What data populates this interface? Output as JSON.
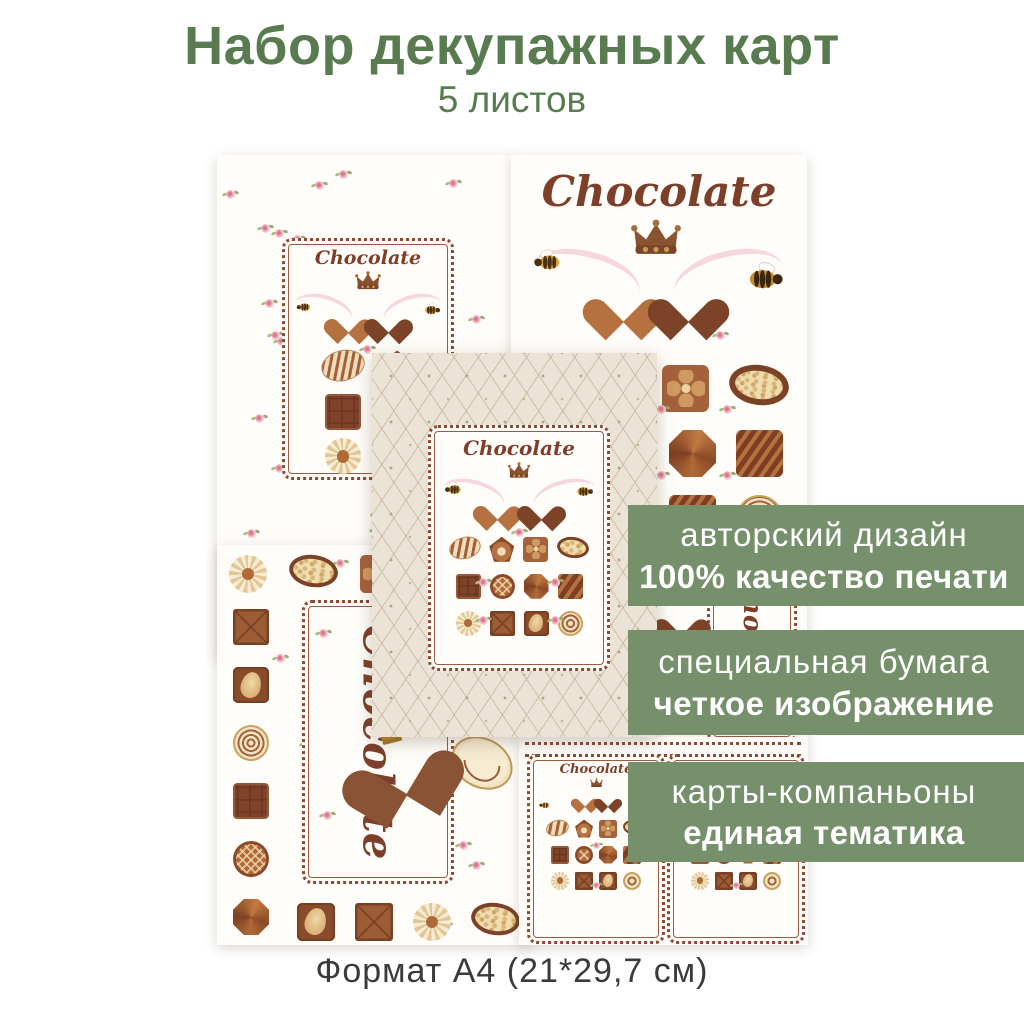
{
  "header": {
    "title": "Набор декупажных карт",
    "subtitle": "5 листов",
    "color": "#587b50"
  },
  "footer": {
    "caption": "Формат А4 (21*29,7 см)",
    "color": "#3b3b3b"
  },
  "banners": {
    "color": "#75906b",
    "items": [
      {
        "line1": "авторский дизайн",
        "line2": "100% качество печати"
      },
      {
        "line1": "специальная бумага",
        "line2": "четкое изображение"
      },
      {
        "line1": "карты-компаньоны",
        "line2": "единая тематика"
      }
    ]
  },
  "sheet_count": "5",
  "card_title": "Chocolate",
  "colors": {
    "script_brown": "#7d3f2a",
    "frame_brown": "#8a4a33",
    "quilt_beige": "#ebe3d6",
    "rose_pink": "#eda4b4",
    "chocolate_dark": "#7e432a",
    "chocolate_milk": "#b06a3a",
    "cream": "#f2e3c2",
    "ribbon_pink": "#f6d7db"
  },
  "decor": {
    "grid_2col": [
      [
        "oval-striped",
        "pentagon"
      ],
      [
        "choc-square",
        "waffle"
      ],
      [
        "meringue",
        "bar"
      ]
    ],
    "grid_4col": [
      [
        "oval-striped",
        "pentagon",
        "flower-square",
        "nut-oval"
      ],
      [
        "choc-square",
        "waffle",
        "gem",
        "swirl-square"
      ],
      [
        "meringue",
        "bar",
        "almond-square",
        "swirl-round"
      ]
    ],
    "grid_b": [
      [
        "flower-square",
        "nut-oval"
      ],
      [
        "gem",
        "swirl-square"
      ],
      [
        "swirl-square",
        "swirl-round"
      ]
    ],
    "d_top_row": [
      "meringue",
      "nut-oval",
      "flower-square"
    ],
    "d_left_col": [
      "bar",
      "almond-square",
      "swirl-round",
      "choc-square",
      "waffle",
      "gem"
    ],
    "d_bottom_row": [
      "almond-square",
      "bar",
      "meringue",
      "nut-oval"
    ]
  }
}
